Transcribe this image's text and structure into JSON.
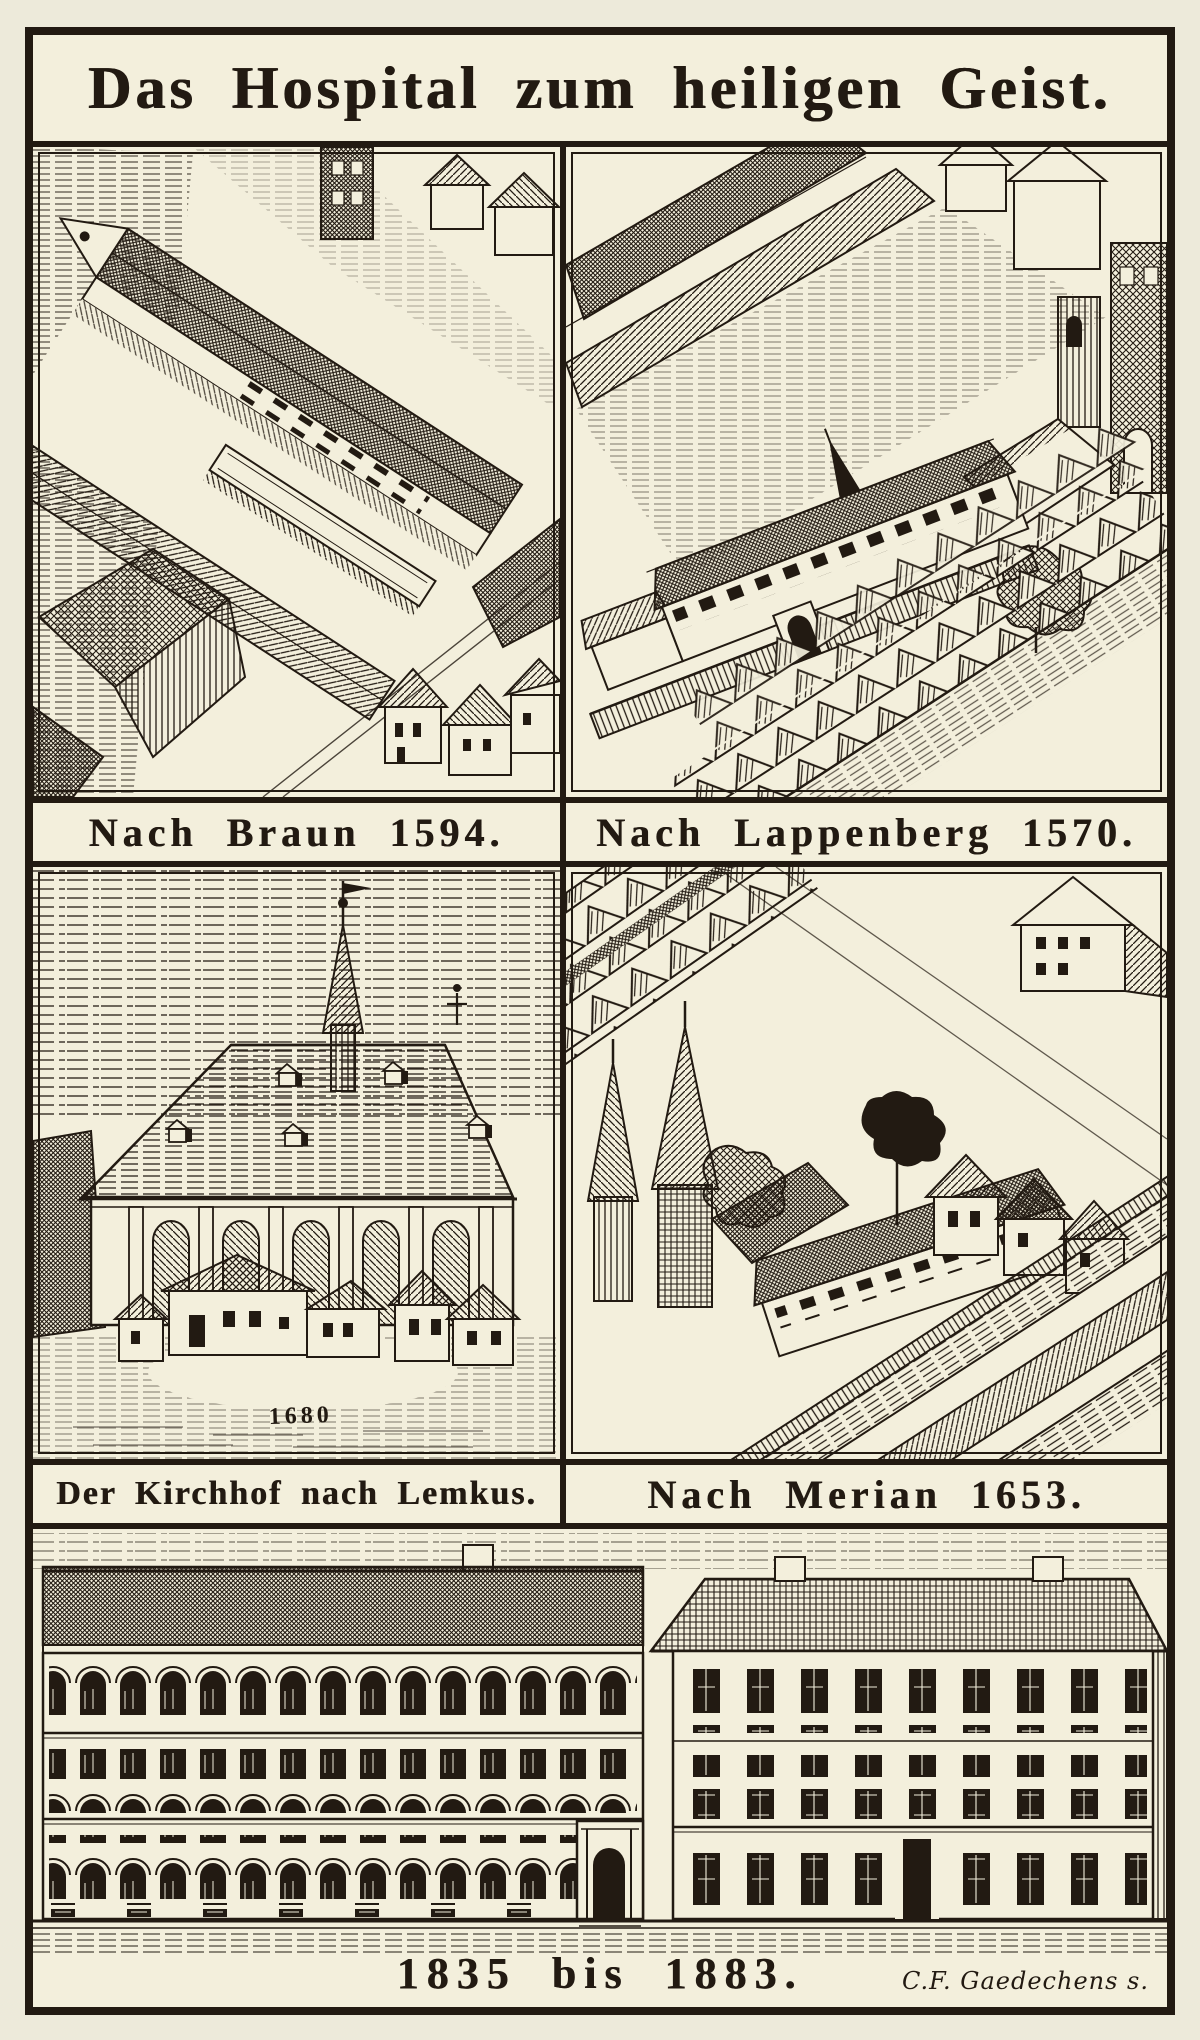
{
  "plate": {
    "title": "Das Hospital zum heiligen Geist.",
    "panels": {
      "braun": {
        "caption": "Nach Braun 1594."
      },
      "lappenberg": {
        "caption": "Nach Lappenberg 1570."
      },
      "lemkus": {
        "caption": "Der Kirchhof nach Lemkus.",
        "inscription": "1680"
      },
      "merian": {
        "caption": "Nach Merian 1653."
      },
      "modern": {
        "caption": "1835 bis 1883.",
        "signature": "C.F. Gaedechens s."
      }
    },
    "colors": {
      "paper": "#f3efdc",
      "ink": "#221a12"
    }
  }
}
